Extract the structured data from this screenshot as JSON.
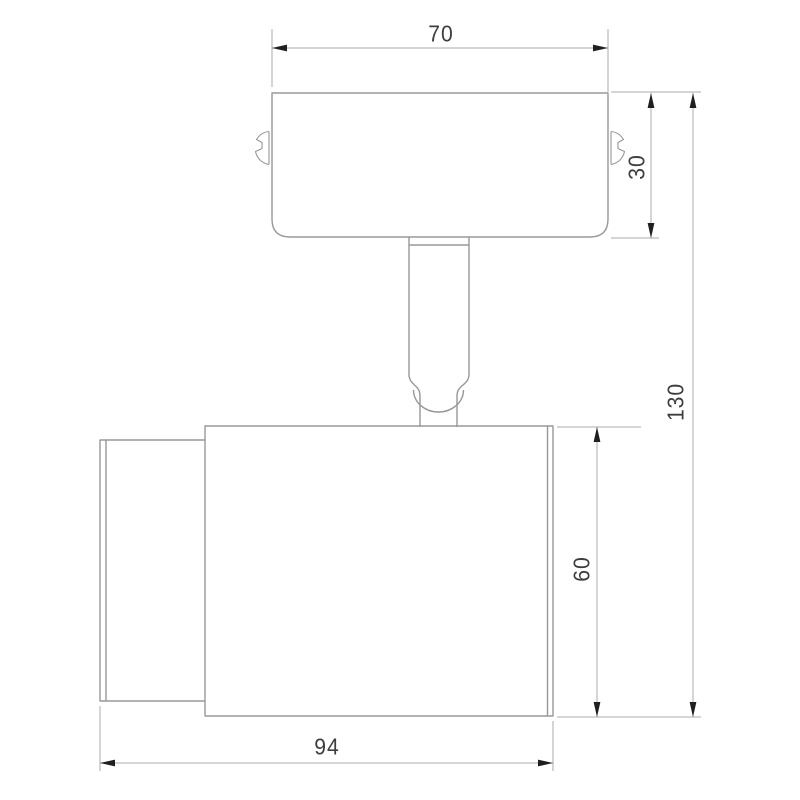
{
  "drawing": {
    "type": "technical-dimension-drawing",
    "subject": "wall-mounted-spotlight-side-view",
    "dimensions": {
      "top_width": "70",
      "plate_height": "30",
      "total_height": "130",
      "body_height": "60",
      "bottom_width": "94"
    },
    "colors": {
      "background": "#ffffff",
      "outline": "#989898",
      "dimension_line": "#ababab",
      "arrowhead": "#1f1f1f",
      "text": "#3e3e3e"
    }
  }
}
